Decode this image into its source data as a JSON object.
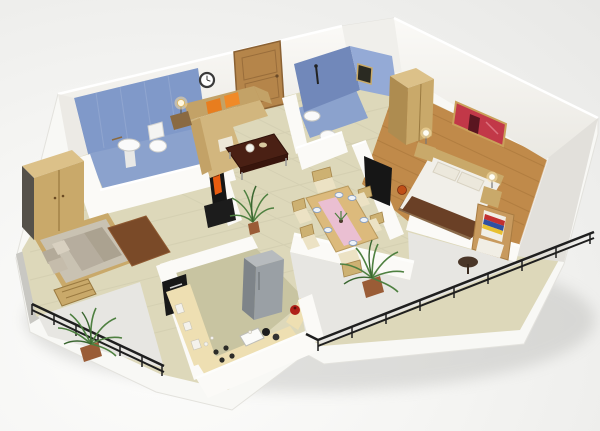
{
  "scene": {
    "kind": "isometric 3d floor plan render",
    "subject": "two-bedroom apartment with two bathrooms, kitchen, dining area and wrap balcony",
    "rooms": [
      {
        "id": "living-room",
        "floor": "cream tile",
        "objects": [
          "entry door",
          "wall clock",
          "l-shaped sofa",
          "orange cushions",
          "side table with lamp",
          "dark coffee table",
          "tv unit with orange screen",
          "potted plant"
        ]
      },
      {
        "id": "bathroom-1",
        "walls": "blue tile",
        "objects": [
          "pedestal sink",
          "toilet"
        ]
      },
      {
        "id": "bathroom-2",
        "walls": "blue tile",
        "objects": [
          "wall sink",
          "toilet",
          "window",
          "shower fitting"
        ]
      },
      {
        "id": "master-bedroom",
        "floor": "wood planks",
        "objects": [
          "double bed with brown runner",
          "bedside tables",
          "ball lamps",
          "wardrobe",
          "red wall poster",
          "wall tv",
          "basketball"
        ]
      },
      {
        "id": "second-bedroom",
        "floor": "cream tile",
        "objects": [
          "double bed",
          "pillows",
          "wooden bench",
          "brown rug",
          "wardrobe"
        ]
      },
      {
        "id": "dining-area",
        "objects": [
          "six seat dining table",
          "pink table runner",
          "place settings",
          "centerpiece plant"
        ]
      },
      {
        "id": "kitchen",
        "floor": "olive tile",
        "objects": [
          "u-shaped counter",
          "refrigerator",
          "dark wall shelf unit",
          "hob with pans",
          "sink",
          "red pot"
        ]
      },
      {
        "id": "main-balcony",
        "objects": [
          "black metal railing",
          "wicker armchair with striped throw",
          "round side table",
          "potted palm"
        ]
      },
      {
        "id": "small-balcony",
        "objects": [
          "black metal railing",
          "potted palm"
        ]
      }
    ],
    "palette": {
      "skirt": "#f8f8f5",
      "wall_white": "#f3f2ee",
      "wall_bright": "#fbfaf7",
      "wall_shade": "#e2e0db",
      "wall_dark": "#c9c8c3",
      "floor_cream": "#ddd8ba",
      "floor_kitchen": "#c8c4a1",
      "floor_wood": "#c08a4a",
      "tile_blue_wall": "#8099c9",
      "tile_blue_dark": "#7188ba",
      "tile_blue_light": "#94aad6",
      "tile_blue_floor": "#8ba2cd",
      "balcony_gray": "#e7e6e2",
      "railing": "#1f1f1f",
      "door_wood": "#b5854a",
      "sofa_tan": "#c3a267",
      "sofa_seat": "#d2b67e",
      "pillow_orange": "#e87d1e",
      "cushion_cream": "#eee8d8",
      "coffee_table": "#4a2014",
      "tv_black": "#161616",
      "screen_orange": "#e85c10",
      "table_wood": "#dcba7c",
      "runner_pink": "#eabfd2",
      "chair_wood": "#cdb172",
      "fridge": "#9aa0a5",
      "fridge_dark": "#7e8489",
      "counter": "#eedfb2",
      "shelf_black": "#181818",
      "bed_white": "#f1efe9",
      "bed_runner": "#6a4026",
      "mattress_gray": "#c9c2b2",
      "pillow_gray": "#b3aa99",
      "rug_brown": "#7a4a28",
      "wood_furn": "#c9a96a",
      "wood_furn_light": "#dcc189",
      "wood_furn_dark": "#ae8c50",
      "poster_red": "#c23848",
      "plant_green": "#4e8040",
      "plant_dark": "#3a6630",
      "pot_terracotta": "#9a5c36",
      "ball_orange": "#c05018",
      "pot_red": "#b02018"
    }
  }
}
